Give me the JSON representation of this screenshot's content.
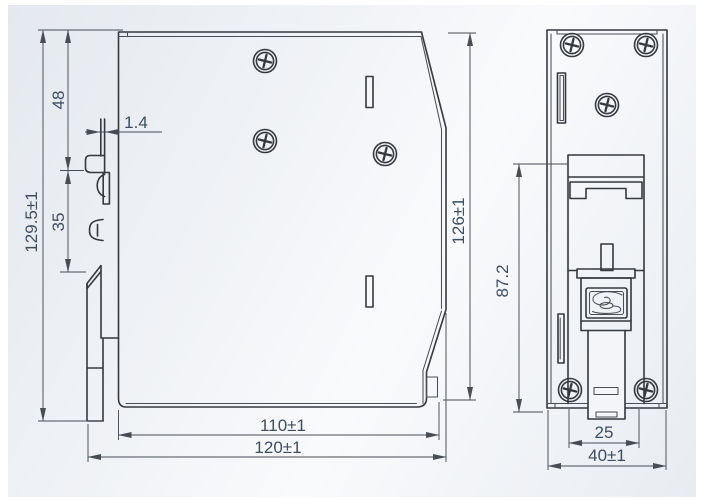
{
  "drawing": {
    "kind": "mechanical-dimension-drawing",
    "views": {
      "side": "side-view",
      "rear": "rear-view"
    },
    "dims": {
      "height_total": "129.5±1",
      "top_to_rail": "48",
      "clip_plate_thickness": "1.4",
      "din_rail_height": "35",
      "case_height": "126±1",
      "case_depth": "110±1",
      "overall_depth": "120±1",
      "clip_region_height": "87.2",
      "clip_slot_width": "25",
      "overall_width": "40±1"
    },
    "colors": {
      "part_line": "#35393e",
      "dimension_line": "#474d55",
      "dimension_text": "#3d4e63",
      "background_top": "#e4e9ef",
      "background_bottom": "#e8ecf1",
      "part_fill": "#f3f5f8",
      "screw_fill": "#fbfcfd"
    }
  }
}
